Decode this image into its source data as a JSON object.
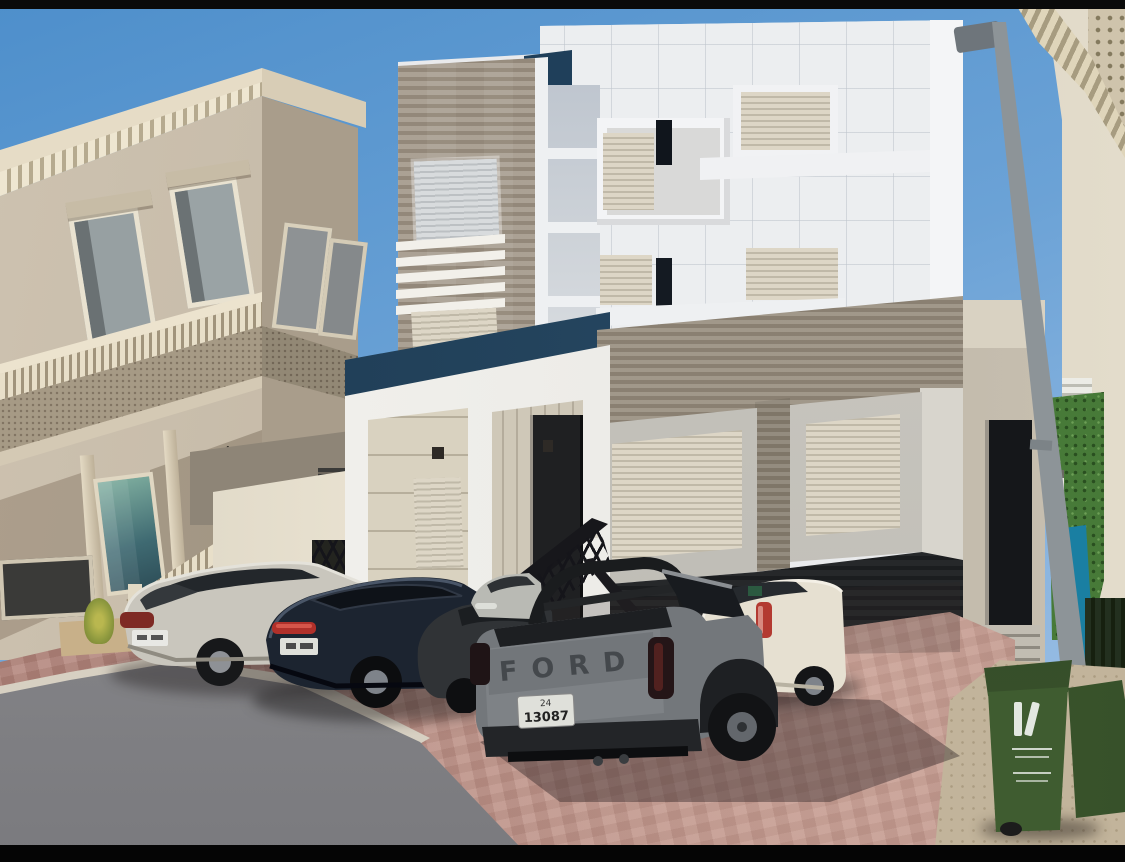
{
  "scene": {
    "setting": "daytime street photo of residential villas with cars parked in front",
    "sky_color": "#5d97d0",
    "letterbox_color": "#0a0a0a"
  },
  "buildings": {
    "left_villa": {
      "label": "ornate beige villa",
      "wall_color": "#c3b7a4",
      "frieze_style": "arabesque carved band",
      "glass_color": "#4f7a7e"
    },
    "center_villa": {
      "label": "modern white villa",
      "wall_color": "#ebedef",
      "stone_color": "#9e9488",
      "parapet_color": "#1f3f5a",
      "shutter_color": "#d8d1c0",
      "door_color": "#1f2022"
    },
    "right_building": {
      "label": "cream stone building",
      "wall_color": "#d6cdbd",
      "hedge_color": "#477a38",
      "blue_feature_color": "#2ba6c6"
    }
  },
  "street": {
    "road_color": "#8e8e90",
    "paver_color": "#b3867c",
    "curb_color": "#d7d0c2",
    "sand_color": "#c2b49b"
  },
  "vehicles": [
    {
      "id": "silver-suv",
      "label": "silver crossover SUV",
      "color": "#c9c6bd"
    },
    {
      "id": "dark-blue-suv",
      "label": "dark blue coupe SUV",
      "color": "#1c2430"
    },
    {
      "id": "dark-gray-suv",
      "label": "dark gray SUV",
      "color": "#303336"
    },
    {
      "id": "silver-sedan",
      "label": "silver sedan",
      "color": "#b9bab4"
    },
    {
      "id": "white-suv",
      "label": "white SUV",
      "color": "#e6e0d1"
    },
    {
      "id": "gray-pickup",
      "label": "gray pickup truck",
      "color": "#73777b",
      "tailgate_text": "FORD",
      "license_plate": {
        "line1": "24",
        "line2": "13087"
      }
    }
  ],
  "objects": {
    "trash_bins": {
      "label": "green wheelie bins",
      "count": 2,
      "color": "#4a6837"
    },
    "lamp_post": {
      "label": "street lamp post",
      "color": "#aeb4b8"
    }
  }
}
